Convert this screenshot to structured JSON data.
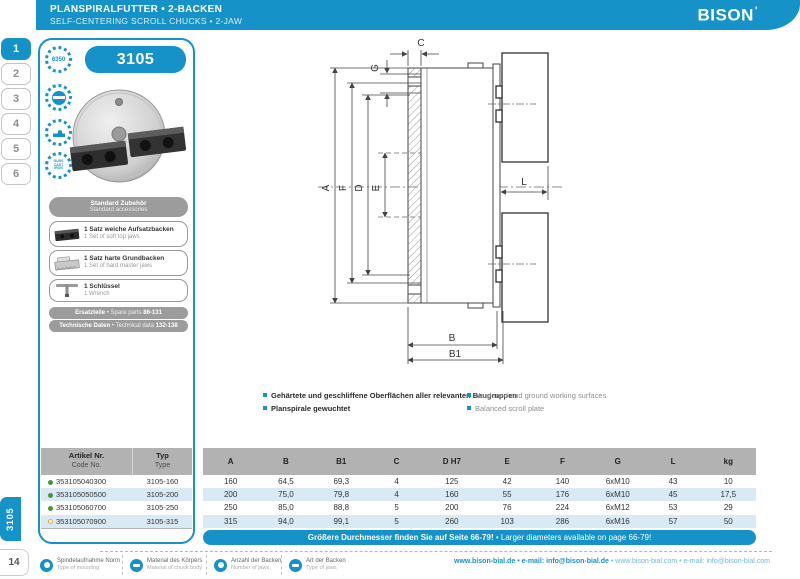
{
  "misc": {
    "bullet": "•"
  },
  "header": {
    "title_de": "PLANSPIRALFUTTER • 2-BACKEN",
    "title_en": "SELF-CENTERING SCROLL CHUCKS • 2-JAW",
    "brand": "BISON"
  },
  "sidebar": {
    "tabs": [
      "1",
      "2",
      "3",
      "4",
      "5",
      "6"
    ],
    "active_tab": "1",
    "series_tab": "3105",
    "page_number": "14"
  },
  "panel": {
    "series": "3105",
    "badges": {
      "rpm": "6350",
      "material_lines": [
        "GUSS",
        "CAST",
        "IRON"
      ]
    },
    "accessories_header": {
      "de": "Standard Zubehör",
      "en": "Standard accessories"
    },
    "accessories": [
      {
        "de": "1 Satz weiche Aufsatzbacken",
        "en": "1 Set of soft top jaws"
      },
      {
        "de": "1 Satz harte Grundbacken",
        "en": "1 Set of hard master jaws"
      },
      {
        "de": "1 Schlüssel",
        "en": "1 Wrench"
      }
    ],
    "links": [
      {
        "de": "Ersatzteile",
        "en": "Spare parts",
        "pages": "86-131"
      },
      {
        "de": "Technische Daten",
        "en": "Technical data",
        "pages": "132-138"
      }
    ]
  },
  "drawing": {
    "labels": {
      "a": "A",
      "f": "F",
      "d": "D",
      "e": "E",
      "c": "C",
      "g": "G",
      "l": "L",
      "b": "B",
      "b1": "B1"
    }
  },
  "features": {
    "de": [
      "Gehärtete und geschliffene Oberflächen aller relevanten Baugruppen",
      "Planspirale gewuchtet"
    ],
    "en": [
      "Hardened and ground working surfaces",
      "Balanced scroll plate"
    ]
  },
  "table": {
    "left_headers": {
      "artikel": "Artikel Nr.",
      "code": "Code No.",
      "typ": "Typ",
      "type": "Type"
    },
    "columns": [
      "A",
      "B",
      "B1",
      "C",
      "D H7",
      "E",
      "F",
      "G",
      "L",
      "kg"
    ],
    "rows": [
      {
        "code": "353105040300",
        "dot": "green",
        "type": "3105-160",
        "values": [
          "160",
          "64,5",
          "69,3",
          "4",
          "125",
          "42",
          "140",
          "6xM10",
          "43",
          "10"
        ]
      },
      {
        "code": "353105050500",
        "dot": "green",
        "type": "3105-200",
        "values": [
          "200",
          "75,0",
          "79,8",
          "4",
          "160",
          "55",
          "176",
          "6xM10",
          "45",
          "17,5"
        ]
      },
      {
        "code": "353105060700",
        "dot": "green",
        "type": "3105-250",
        "values": [
          "250",
          "85,0",
          "88,8",
          "5",
          "200",
          "76",
          "224",
          "6xM12",
          "53",
          "29"
        ]
      },
      {
        "code": "353105070900",
        "dot": "orange",
        "type": "3105-315",
        "values": [
          "315",
          "94,0",
          "99,1",
          "5",
          "260",
          "103",
          "286",
          "6xM16",
          "57",
          "50"
        ]
      }
    ],
    "note_de": "Größere Durchmesser finden Sie auf Seite 66-79!",
    "note_en": "Larger diameters available on page 66-79!"
  },
  "footer": {
    "legend": [
      {
        "de": "Spindelaufnahme Norm",
        "en": "Type of mounting"
      },
      {
        "de": "Material des Körpers",
        "en": "Material of chuck body"
      },
      {
        "de": "Anzahl der Backen",
        "en": "Number of jaws"
      },
      {
        "de": "Art der Backen",
        "en": "Type of jaws"
      }
    ],
    "links": [
      "www.bison-bial.de",
      "e-mail: info@bison-bial.de",
      "www.bison-bial.com",
      "e-mail: info@bison-bial.com"
    ]
  },
  "colors": {
    "brand": "#1592c8",
    "row_alt": "#d9eaf4",
    "header_band": "#b2b2b2",
    "status_green": "#3f9c35",
    "status_orange": "#f5a81c"
  }
}
